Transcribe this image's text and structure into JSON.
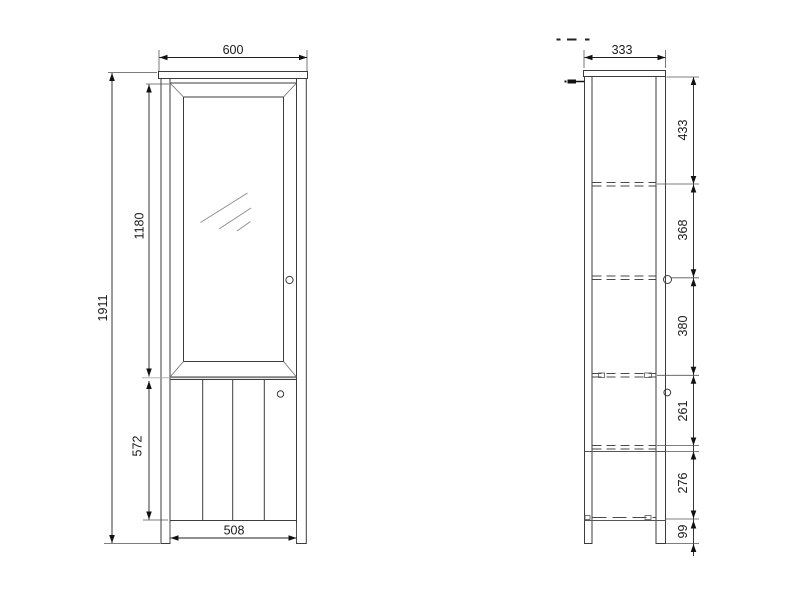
{
  "views": {
    "front": {
      "dims": {
        "overall_width": "600",
        "overall_height": "1911",
        "glass_door_height": "1180",
        "lower_section_height": "572",
        "door_width": "508"
      }
    },
    "side": {
      "dims": {
        "depth": "333",
        "segments": [
          "433",
          "368",
          "380",
          "261",
          "276",
          "99"
        ]
      }
    }
  },
  "colors": {
    "background": "#ffffff",
    "main_line": "#3c3c3c",
    "dimension_line": "#1f1f1f",
    "hidden_line": "#4a4a4a",
    "auxiliary_line": "#a8a8a8",
    "text": "#1a1a1a"
  }
}
